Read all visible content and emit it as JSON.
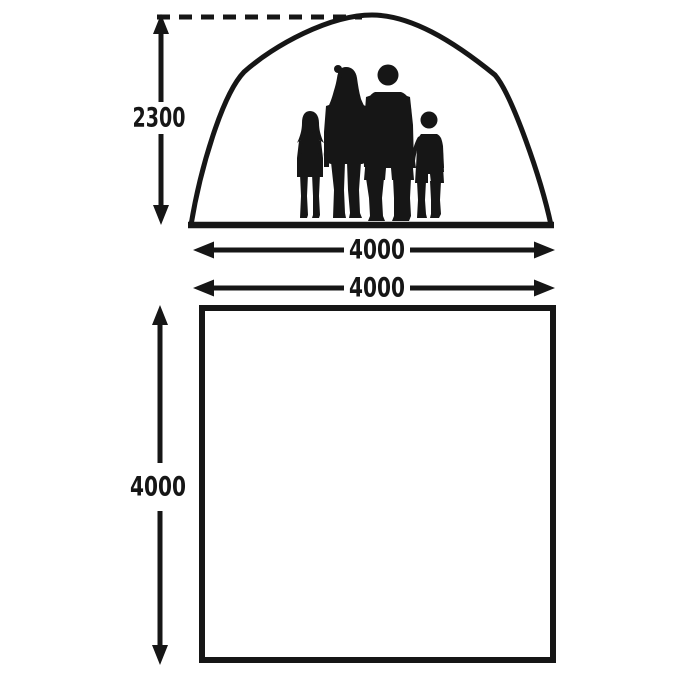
{
  "colors": {
    "ink": "#161616",
    "background": "#ffffff"
  },
  "elevation_view": {
    "height_dimension_label": "2300",
    "width_dimension_label": "4000"
  },
  "floor_plan": {
    "width_dimension_label": "4000",
    "height_dimension_label": "4000"
  }
}
